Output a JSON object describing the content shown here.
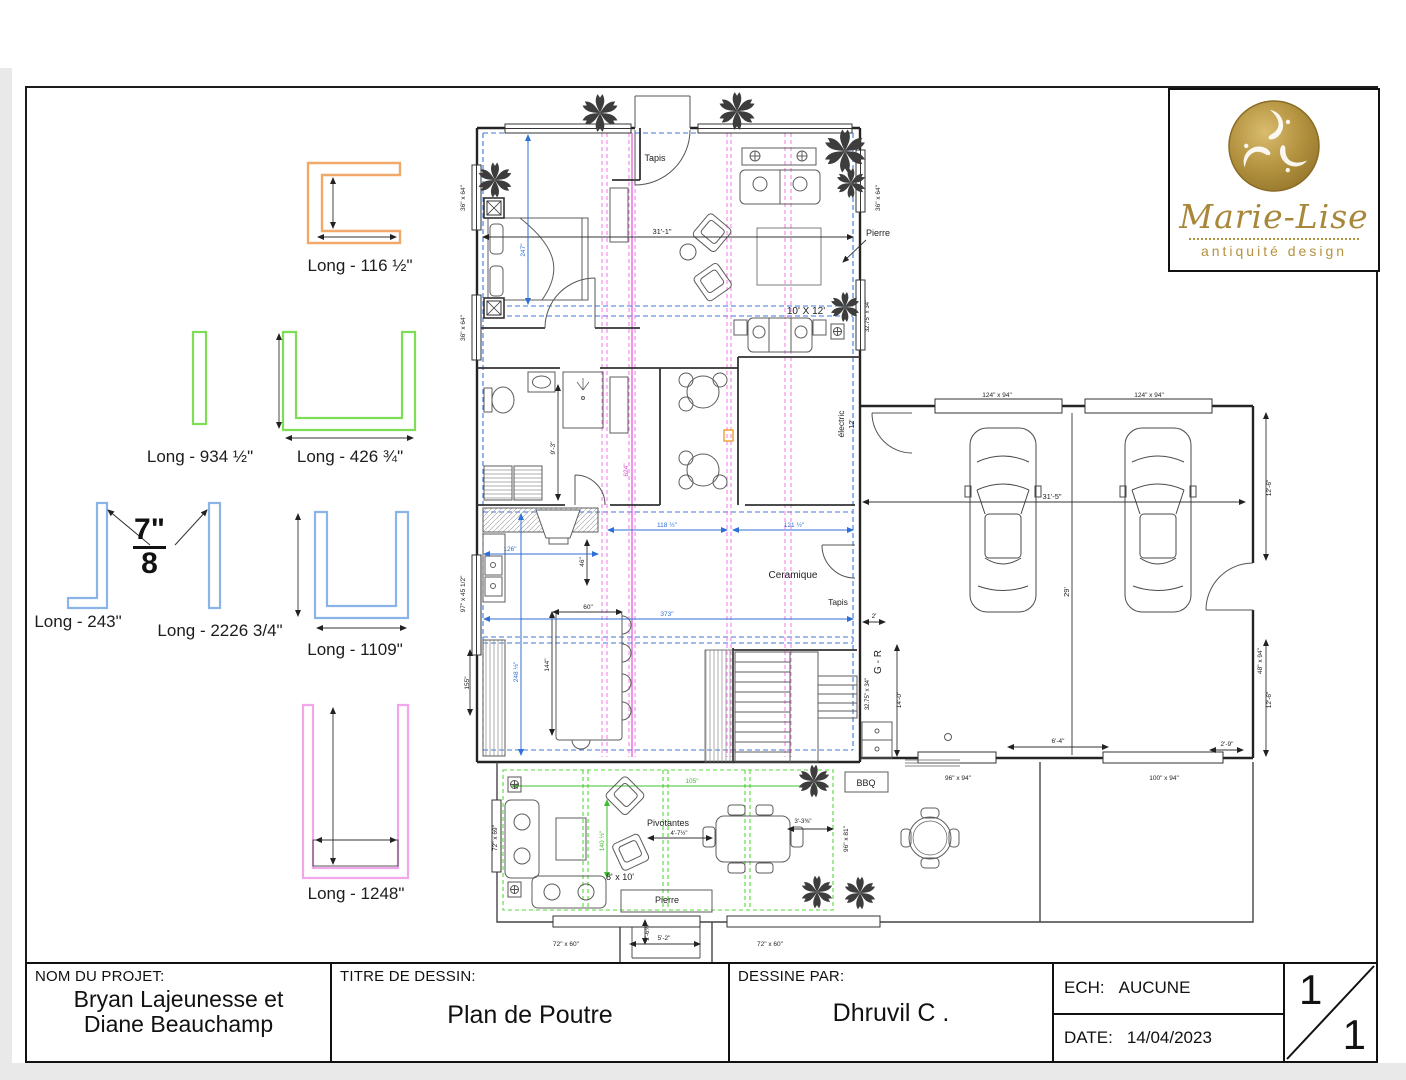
{
  "title_block": {
    "project_label": "NOM DU PROJET:",
    "project_name_line1": "Bryan Lajeunesse et",
    "project_name_line2": "Diane Beauchamp",
    "drawing_label": "TITRE DE DESSIN:",
    "drawing_title": "Plan de Poutre",
    "author_label": "DESSINE PAR:",
    "author_name": "Dhruvil C .",
    "scale_label": "ECH:",
    "scale_value": "AUCUNE",
    "date_label": "DATE:",
    "date_value": "14/04/2023",
    "page_current": "1",
    "page_total": "1"
  },
  "logo": {
    "brand": "Marie-Lise",
    "tagline": "antiquité design",
    "gold": "#b3923f"
  },
  "legend": {
    "fraction": {
      "numerator": "7",
      "unit": "\"",
      "denominator": "8"
    },
    "items": [
      {
        "label": "Long - 116 ½\"",
        "color": "#f0a96a",
        "x": 360,
        "y": 256
      },
      {
        "label": "Long - 934 ½\"",
        "color": "#7ddd55",
        "x": 200,
        "y": 447
      },
      {
        "label": "Long - 426 ¾\"",
        "color": "#7ddd55",
        "x": 350,
        "y": 447
      },
      {
        "label": "Long - 243\"",
        "color": "#8ab4e8",
        "x": 78,
        "y": 612
      },
      {
        "label": "Long - 2226 3/4\"",
        "color": "#8ab4e8",
        "x": 220,
        "y": 621
      },
      {
        "label": "Long - 1109\"",
        "color": "#8ab4e8",
        "x": 355,
        "y": 640
      },
      {
        "label": "Long - 1248\"",
        "color": "#f2a6ec",
        "x": 356,
        "y": 884
      }
    ]
  },
  "plan": {
    "labels": [
      {
        "text": "Tapis",
        "x": 655,
        "y": 161,
        "r": 0,
        "s": 9,
        "c": "k"
      },
      {
        "text": "Pierre",
        "x": 878,
        "y": 236,
        "r": 0,
        "s": 9,
        "c": "k"
      },
      {
        "text": "10' X 12'",
        "x": 806,
        "y": 314,
        "r": 0,
        "s": 10,
        "c": "k"
      },
      {
        "text": "31'-1\"",
        "x": 662,
        "y": 234,
        "r": 0,
        "s": 7.5,
        "c": "k"
      },
      {
        "text": "36\" x 64\"",
        "x": 465,
        "y": 198,
        "r": -90,
        "s": 6.5,
        "c": "k"
      },
      {
        "text": "36\" x 64\"",
        "x": 465,
        "y": 328,
        "r": -90,
        "s": 6.5,
        "c": "k"
      },
      {
        "text": "36\" x 64\"",
        "x": 880,
        "y": 198,
        "r": -90,
        "s": 6.5,
        "c": "k"
      },
      {
        "text": "32.75\" x 34\"",
        "x": 869,
        "y": 316,
        "r": -90,
        "s": 6,
        "c": "k"
      },
      {
        "text": "électric",
        "x": 844,
        "y": 424,
        "r": -90,
        "s": 8.5,
        "c": "k"
      },
      {
        "text": "12'",
        "x": 854,
        "y": 424,
        "r": -90,
        "s": 7,
        "c": "k"
      },
      {
        "text": "Ceramique",
        "x": 793,
        "y": 578,
        "r": 0,
        "s": 10,
        "c": "k"
      },
      {
        "text": "Tapis",
        "x": 838,
        "y": 605,
        "r": 0,
        "s": 8.5,
        "c": "k"
      },
      {
        "text": "G - R",
        "x": 881,
        "y": 662,
        "r": -90,
        "s": 10,
        "c": "k"
      },
      {
        "text": "32.75\" x 34\"",
        "x": 869,
        "y": 694,
        "r": -90,
        "s": 6,
        "c": "k"
      },
      {
        "text": "97\" x 45 1/2\"",
        "x": 465,
        "y": 594,
        "r": -90,
        "s": 6.5,
        "c": "k"
      },
      {
        "text": "155\"",
        "x": 469,
        "y": 683,
        "r": -90,
        "s": 6.5,
        "c": "k"
      },
      {
        "text": "247\"",
        "x": 525,
        "y": 250,
        "r": -90,
        "s": 6.5,
        "c": "b"
      },
      {
        "text": "248 ½\"",
        "x": 518,
        "y": 672,
        "r": -90,
        "s": 6.5,
        "c": "b"
      },
      {
        "text": "144\"",
        "x": 549,
        "y": 665,
        "r": -90,
        "s": 6.5,
        "c": "k"
      },
      {
        "text": "60\"",
        "x": 588,
        "y": 609,
        "r": 0,
        "s": 6.5,
        "c": "k"
      },
      {
        "text": "46\"",
        "x": 584,
        "y": 562,
        "r": -90,
        "s": 6.5,
        "c": "k"
      },
      {
        "text": "126\"",
        "x": 510,
        "y": 551,
        "r": 0,
        "s": 6.5,
        "c": "b"
      },
      {
        "text": "118 ½\"",
        "x": 667,
        "y": 527,
        "r": 0,
        "s": 6.5,
        "c": "b"
      },
      {
        "text": "121 ½\"",
        "x": 794,
        "y": 527,
        "r": 0,
        "s": 6.5,
        "c": "b"
      },
      {
        "text": "373\"",
        "x": 667,
        "y": 616,
        "r": 0,
        "s": 6.5,
        "c": "b"
      },
      {
        "text": "624\"",
        "x": 628,
        "y": 470,
        "r": -90,
        "s": 6.5,
        "c": "m"
      },
      {
        "text": "9'-3\"",
        "x": 555,
        "y": 448,
        "r": -90,
        "s": 6.5,
        "c": "k"
      },
      {
        "text": "31'-5\"",
        "x": 1052,
        "y": 499,
        "r": 0,
        "s": 7.5,
        "c": "k"
      },
      {
        "text": "29'",
        "x": 1069,
        "y": 592,
        "r": -90,
        "s": 7.5,
        "c": "k"
      },
      {
        "text": "12'-6\"",
        "x": 1271,
        "y": 488,
        "r": -90,
        "s": 6.5,
        "c": "k"
      },
      {
        "text": "12'-6\"",
        "x": 1271,
        "y": 700,
        "r": -90,
        "s": 6.5,
        "c": "k"
      },
      {
        "text": "124\" x 94\"",
        "x": 997,
        "y": 397,
        "r": 0,
        "s": 6.5,
        "c": "k"
      },
      {
        "text": "124\" x 94\"",
        "x": 1149,
        "y": 397,
        "r": 0,
        "s": 6.5,
        "c": "k"
      },
      {
        "text": "48\" x 94\"",
        "x": 1262,
        "y": 661,
        "r": -90,
        "s": 6.5,
        "c": "k"
      },
      {
        "text": "14'-0\"",
        "x": 901,
        "y": 700,
        "r": -90,
        "s": 6.5,
        "c": "k"
      },
      {
        "text": "6'-4\"",
        "x": 1058,
        "y": 743,
        "r": 0,
        "s": 6.5,
        "c": "k"
      },
      {
        "text": "2'-9\"",
        "x": 1227,
        "y": 746,
        "r": 0,
        "s": 6.5,
        "c": "k"
      },
      {
        "text": "2'",
        "x": 874,
        "y": 618,
        "r": 0,
        "s": 6.5,
        "c": "k"
      },
      {
        "text": "96\" x 94\"",
        "x": 958,
        "y": 780,
        "r": 0,
        "s": 6.5,
        "c": "k"
      },
      {
        "text": "100\" x 94\"",
        "x": 1164,
        "y": 780,
        "r": 0,
        "s": 6.5,
        "c": "k"
      },
      {
        "text": "BBQ",
        "x": 866,
        "y": 786,
        "r": 0,
        "s": 9,
        "c": "k"
      },
      {
        "text": "Pivotantes",
        "x": 668,
        "y": 826,
        "r": 0,
        "s": 9,
        "c": "k"
      },
      {
        "text": "8' x 10'",
        "x": 620,
        "y": 880,
        "r": 0,
        "s": 9,
        "c": "k"
      },
      {
        "text": "Pierre",
        "x": 667,
        "y": 903,
        "r": 0,
        "s": 9,
        "c": "k"
      },
      {
        "text": "105\"",
        "x": 692,
        "y": 783,
        "r": 0,
        "s": 6.5,
        "c": "g"
      },
      {
        "text": "140 ½\"",
        "x": 604,
        "y": 841,
        "r": -90,
        "s": 6.5,
        "c": "g"
      },
      {
        "text": "4'-7½\"",
        "x": 679,
        "y": 835,
        "r": 0,
        "s": 6,
        "c": "k"
      },
      {
        "text": "3'-3⅜\"",
        "x": 803,
        "y": 823,
        "r": 0,
        "s": 6,
        "c": "k"
      },
      {
        "text": "72\" x 69\"",
        "x": 497,
        "y": 838,
        "r": -90,
        "s": 6.5,
        "c": "k"
      },
      {
        "text": "96\" x 81\"",
        "x": 848,
        "y": 839,
        "r": -90,
        "s": 6.5,
        "c": "k"
      },
      {
        "text": "72\" x 60\"",
        "x": 566,
        "y": 946,
        "r": 0,
        "s": 6.5,
        "c": "k"
      },
      {
        "text": "72\" x 60\"",
        "x": 770,
        "y": 946,
        "r": 0,
        "s": 6.5,
        "c": "k"
      },
      {
        "text": "5'-2\"",
        "x": 664,
        "y": 940,
        "r": 0,
        "s": 6.5,
        "c": "k"
      },
      {
        "text": "2'-6⅜\"",
        "x": 649,
        "y": 932,
        "r": -90,
        "s": 6,
        "c": "k"
      }
    ]
  }
}
